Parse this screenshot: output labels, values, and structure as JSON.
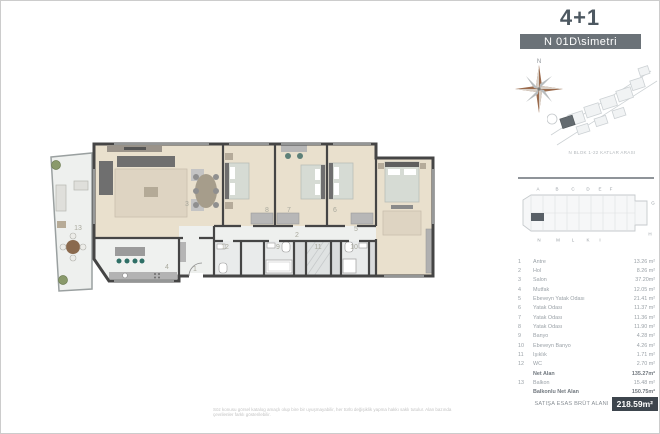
{
  "header": {
    "type_label": "4+1",
    "unit_label": "N 01D\\simetri"
  },
  "compass": {
    "north_label": "N"
  },
  "site": {
    "caption": "N BLOK 1-22 KATLAR ARASI"
  },
  "keyplan": {
    "top_letters": [
      "A",
      "B",
      "C",
      "D",
      "E",
      "F"
    ],
    "right_letters": [
      "G",
      "H"
    ],
    "bottom_letters": [
      "N",
      "M",
      "L",
      "K",
      "I"
    ]
  },
  "legend": {
    "rows": [
      {
        "no": "1",
        "label": "Antre",
        "value": "13.26 m²",
        "bold": false
      },
      {
        "no": "2",
        "label": "Hol",
        "value": "8.26 m²",
        "bold": false
      },
      {
        "no": "3",
        "label": "Salon",
        "value": "37.20m²",
        "bold": false
      },
      {
        "no": "4",
        "label": "Mutfak",
        "value": "12.05 m²",
        "bold": false
      },
      {
        "no": "5",
        "label": "Ebeveyn Yatak Odası",
        "value": "21.41 m²",
        "bold": false
      },
      {
        "no": "6",
        "label": "Yatak Odası",
        "value": "11.37 m²",
        "bold": false
      },
      {
        "no": "7",
        "label": "Yatak Odası",
        "value": "11.36 m²",
        "bold": false
      },
      {
        "no": "8",
        "label": "Yatak Odası",
        "value": "11.90 m²",
        "bold": false
      },
      {
        "no": "9",
        "label": "Banyo",
        "value": "4.28 m²",
        "bold": false
      },
      {
        "no": "10",
        "label": "Ebeveyn Banyo",
        "value": "4.26 m²",
        "bold": false
      },
      {
        "no": "11",
        "label": "Işıklık",
        "value": "1.71 m²",
        "bold": false
      },
      {
        "no": "12",
        "label": "WC",
        "value": "2.70 m²",
        "bold": false
      },
      {
        "no": "",
        "label": "Net Alan",
        "value": "135.27m²",
        "bold": true
      },
      {
        "no": "13",
        "label": "Balkon",
        "value": "15.48 m²",
        "bold": false
      },
      {
        "no": "",
        "label": "Balkonlu Net Alan",
        "value": "150.75m²",
        "bold": true
      }
    ]
  },
  "footer": {
    "label": "SATIŞA ESAS BRÜT ALANI",
    "value": "218.59m²"
  },
  "plan": {
    "numbers": [
      "1",
      "2",
      "3",
      "4",
      "5",
      "6",
      "7",
      "8",
      "9",
      "10",
      "11",
      "12",
      "13"
    ]
  },
  "disclaimer": "Söz konusu görsel katalog amaçlı olup bire bir uyuşmayabilir, her türlü değişiklik yapma hakkı saklı tutulur. Alan bazında çevrilenler farklı gösterilebilir.",
  "colors": {
    "accent_dark": "#3d454d",
    "unit_bar": "#6b7278",
    "wall": "#454545",
    "wood_floor": "#e9e0cd"
  }
}
